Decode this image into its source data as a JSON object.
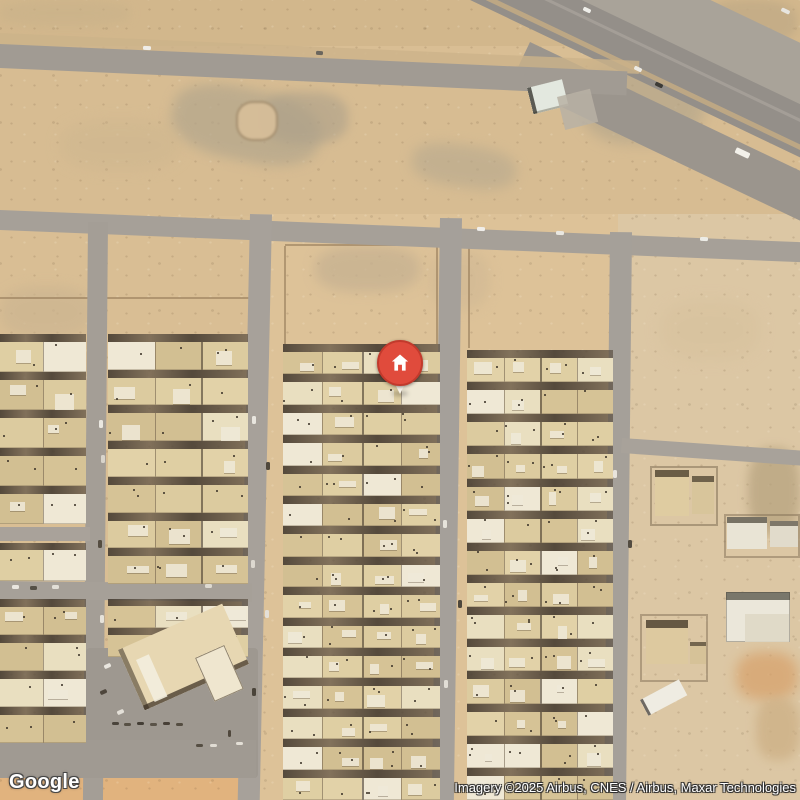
{
  "overlay": {
    "logo_text": "Google",
    "attribution_text": "Imagery ©2025 Airbus, CNES / Airbus, Maxar Technologies"
  },
  "marker": {
    "x": 400,
    "y": 363,
    "r": 23,
    "fill": "#e04b3c",
    "ring": "#c23a2c",
    "tail_color": "#f7f2e8",
    "glyph_color": "#ffffff"
  },
  "map": {
    "width": 800,
    "height": 800,
    "base_color": "#d9be94",
    "wall_color": "rgba(148,122,88,0.6)",
    "alley_color_a": "rgba(66,57,47,0.88)",
    "alley_color_b": "rgba(92,80,66,0.7)",
    "house_palette": [
      "#dccb9f",
      "#e2d2a8",
      "#d6c396",
      "#e9dfc0",
      "#dfcfa3",
      "#efe8d5",
      "#d2bf92"
    ]
  },
  "zones": [
    {
      "x": 0,
      "y": 0,
      "w": 800,
      "h": 46,
      "c": "#d2b78c"
    },
    {
      "x": 0,
      "y": 68,
      "w": 800,
      "h": 148,
      "c": "#d7bc92"
    },
    {
      "x": 252,
      "y": 214,
      "w": 366,
      "h": 586,
      "c": "#ddc298"
    },
    {
      "x": 618,
      "y": 214,
      "w": 182,
      "h": 586,
      "c": "#dcc7a4"
    },
    {
      "x": 0,
      "y": 774,
      "w": 252,
      "h": 26,
      "c": "#e1b37e"
    }
  ],
  "patches": [
    {
      "x": 180,
      "y": 74,
      "w": 150,
      "h": 72,
      "c": "#b3a68c",
      "bl": 6,
      "op": 0.7,
      "rot": 12
    },
    {
      "x": 262,
      "y": 92,
      "w": 86,
      "h": 52,
      "c": "#aca08a",
      "bl": 5,
      "op": 0.6
    },
    {
      "x": 236,
      "y": 101,
      "w": 42,
      "h": 40,
      "c": "#d8bf9a",
      "bl": 1,
      "op": 0.9,
      "sh": "inset 0 0 0 2px rgba(120,100,72,0.55)"
    },
    {
      "x": 580,
      "y": 56,
      "w": 125,
      "h": 88,
      "c": "#b2a58b",
      "bl": 7,
      "op": 0.65
    },
    {
      "x": 415,
      "y": 138,
      "w": 105,
      "h": 42,
      "c": "#b7a98e",
      "bl": 6,
      "op": 0.6,
      "rot": 8
    },
    {
      "x": 315,
      "y": 246,
      "w": 105,
      "h": 46,
      "c": "#c6b191",
      "bl": 6,
      "op": 0.75
    },
    {
      "x": 705,
      "y": 0,
      "w": 92,
      "h": 44,
      "c": "#c3ac87",
      "bl": 4,
      "op": 0.85
    },
    {
      "x": 0,
      "y": 286,
      "w": 92,
      "h": 52,
      "c": "#ccb591",
      "bl": 6,
      "op": 0.7
    },
    {
      "x": 748,
      "y": 448,
      "w": 52,
      "h": 86,
      "c": "#b5a17d",
      "bl": 5,
      "op": 0.7
    },
    {
      "x": 736,
      "y": 652,
      "w": 62,
      "h": 48,
      "c": "#d7a069",
      "bl": 6,
      "op": 0.7
    },
    {
      "x": 756,
      "y": 698,
      "w": 44,
      "h": 62,
      "c": "#ccae83",
      "bl": 5,
      "op": 0.7
    },
    {
      "x": 60,
      "y": 120,
      "w": 120,
      "h": 50,
      "c": "#cdb68f",
      "bl": 7,
      "op": 0.5
    },
    {
      "x": 430,
      "y": 250,
      "w": 60,
      "h": 60,
      "c": "#cdb693",
      "bl": 6,
      "op": 0.5
    },
    {
      "x": 0,
      "y": 0,
      "w": 130,
      "h": 26,
      "c": "#c9b28a",
      "bl": 5,
      "op": 0.6
    },
    {
      "x": 660,
      "y": 300,
      "w": 100,
      "h": 60,
      "c": "#d6c09c",
      "bl": 7,
      "op": 0.5
    }
  ],
  "walls": [
    {
      "x": 0,
      "y": 297,
      "w": 250,
      "h": 2
    },
    {
      "x": 285,
      "y": 244,
      "w": 152,
      "h": 2
    },
    {
      "x": 284,
      "y": 246,
      "w": 2,
      "h": 98
    },
    {
      "x": 436,
      "y": 246,
      "w": 2,
      "h": 98
    },
    {
      "x": 469,
      "y": 240,
      "w": 142,
      "h": 2
    },
    {
      "x": 468,
      "y": 242,
      "w": 2,
      "h": 106
    },
    {
      "x": 0,
      "y": 226,
      "w": 86,
      "h": 2,
      "op": 0.4
    },
    {
      "x": 110,
      "y": 226,
      "w": 138,
      "h": 2,
      "op": 0.4
    }
  ],
  "roads": [
    {
      "n": "highway-service-lane",
      "x": 375,
      "y": -160,
      "w": 780,
      "h": 56,
      "rot": 25.5,
      "c": "#a9a399"
    },
    {
      "n": "highway-main",
      "x": 351,
      "y": -110,
      "w": 780,
      "h": 48,
      "rot": 25.5,
      "c": "#948f89"
    },
    {
      "n": "highway-shoulder",
      "x": 530,
      "y": 42,
      "w": 370,
      "h": 45,
      "rot": 25.5,
      "c": "#9b958d"
    },
    {
      "n": "highway-median",
      "x": 340,
      "y": -75,
      "w": 780,
      "h": 5,
      "rot": 25.5,
      "c": "#c1aa84",
      "op": 0.9
    },
    {
      "n": "highway-lane-line",
      "x": 352,
      "y": -95,
      "w": 780,
      "h": 3,
      "rot": 25.5,
      "c": "#a5a099",
      "op": 0.9
    },
    {
      "n": "road-north-shoulder",
      "x": 0,
      "y": 33,
      "w": 640,
      "h": 13,
      "rot": 2.5,
      "c": "#ccb389",
      "op": 0.8
    },
    {
      "n": "road-north",
      "x": 0,
      "y": 44,
      "w": 628,
      "h": 24,
      "rot": 2.5,
      "c": "#a19b93"
    },
    {
      "n": "road-mid",
      "x": 0,
      "y": 210,
      "w": 812,
      "h": 20,
      "rot": 2.3,
      "c": "#a6a098"
    },
    {
      "n": "street-v1",
      "x": 88,
      "y": 222,
      "w": 20,
      "h": 580,
      "rot": 0.5,
      "c": "#a49e96"
    },
    {
      "n": "street-v2",
      "x": 250,
      "y": 214,
      "w": 22,
      "h": 590,
      "rot": 1.2,
      "c": "#a7a19a"
    },
    {
      "n": "street-v3",
      "x": 440,
      "y": 218,
      "w": 22,
      "h": 586,
      "rot": 0.8,
      "c": "#a5a09a"
    },
    {
      "n": "street-v4",
      "x": 610,
      "y": 232,
      "w": 22,
      "h": 572,
      "rot": 0.6,
      "c": "#a5a099"
    },
    {
      "n": "street-h-left",
      "x": 0,
      "y": 527,
      "w": 90,
      "h": 14,
      "c": "#a9a29a"
    },
    {
      "n": "street-h1",
      "x": 0,
      "y": 581,
      "w": 252,
      "h": 18,
      "rot": 0.6,
      "c": "#a6a098"
    },
    {
      "n": "street-branch-east",
      "x": 622,
      "y": 438,
      "w": 186,
      "h": 15,
      "rot": 4,
      "c": "#a8a29a"
    },
    {
      "n": "parking-southwest",
      "x": 86,
      "y": 648,
      "w": 172,
      "h": 130,
      "c": "#9e9890",
      "rad": 4
    },
    {
      "n": "parking-southwest-2",
      "x": 0,
      "y": 740,
      "w": 256,
      "h": 38,
      "c": "#a09a92"
    }
  ],
  "blocks": [
    {
      "n": "housing-block-a1",
      "x": 0,
      "y": 334,
      "w": 86,
      "h": 190,
      "rows": 5,
      "cols": 2,
      "alley": 8,
      "seed": 11
    },
    {
      "n": "housing-block-a1-mid",
      "x": 0,
      "y": 543,
      "w": 86,
      "h": 38,
      "rows": 1,
      "cols": 2,
      "alley": 7,
      "seed": 12
    },
    {
      "n": "housing-block-a1-south",
      "x": 0,
      "y": 599,
      "w": 86,
      "h": 144,
      "rows": 4,
      "cols": 2,
      "alley": 8,
      "seed": 13
    },
    {
      "n": "housing-block-a2",
      "x": 108,
      "y": 334,
      "w": 140,
      "h": 250,
      "rows": 7,
      "cols": 3,
      "alley": 8,
      "seed": 14
    },
    {
      "n": "housing-block-a2-south",
      "x": 108,
      "y": 599,
      "w": 140,
      "h": 58,
      "rows": 2,
      "cols": 3,
      "alley": 7,
      "seed": 15
    },
    {
      "n": "housing-block-center",
      "x": 283,
      "y": 344,
      "w": 157,
      "h": 456,
      "rows": 15,
      "cols": 4,
      "alley": 8,
      "seed": 16
    },
    {
      "n": "housing-block-east",
      "x": 467,
      "y": 350,
      "w": 146,
      "h": 450,
      "rows": 14,
      "cols": 4,
      "alley": 8,
      "seed": 17
    }
  ],
  "buildings": [
    {
      "n": "warehouse-north",
      "parts": [
        {
          "x": 527,
          "y": 88,
          "w": 36,
          "h": 27,
          "rot": -14,
          "c": "#e3e8df",
          "sh": "inset 4px 0 0 rgba(45,44,38,0.75), inset 0 -2px 0 rgba(120,115,100,0.5)"
        },
        {
          "x": 557,
          "y": 97,
          "w": 34,
          "h": 34,
          "rot": -14,
          "c": "#b8b2a5",
          "op": 0.85
        }
      ]
    },
    {
      "n": "event-hall",
      "parts": [
        {
          "x": 118,
          "y": 650,
          "w": 114,
          "h": 66,
          "rot": -24,
          "c": "#e7d7b2",
          "sh": "inset 0 -5px 0 rgba(52,42,30,0.7), inset 5px 0 0 rgba(60,50,36,0.55)"
        },
        {
          "x": 136,
          "y": 660,
          "w": 14,
          "h": 46,
          "rot": -24,
          "c": "#f3eede",
          "op": 0.9
        },
        {
          "x": 195,
          "y": 658,
          "w": 32,
          "h": 48,
          "rot": -24,
          "c": "#efe6cf",
          "sh": "inset 0 0 0 1px rgba(80,66,48,0.6)"
        }
      ]
    },
    {
      "n": "compound-northeast",
      "parts": [
        {
          "x": 650,
          "y": 466,
          "w": 68,
          "h": 60,
          "c": "rgba(0,0,0,0)",
          "sh": "inset 0 0 0 2px rgba(130,112,86,0.55)"
        },
        {
          "x": 655,
          "y": 470,
          "w": 34,
          "h": 46,
          "c": "#dfcca1",
          "sh": "inset 0 7px 0 rgba(55,45,32,0.7)"
        },
        {
          "x": 692,
          "y": 476,
          "w": 22,
          "h": 38,
          "c": "#d8c59b",
          "sh": "inset 0 6px 0 rgba(55,45,32,0.65)"
        }
      ]
    },
    {
      "n": "compound-east",
      "parts": [
        {
          "x": 724,
          "y": 514,
          "w": 76,
          "h": 44,
          "c": "rgba(0,0,0,0)",
          "sh": "inset 0 0 0 2px rgba(130,112,86,0.5)"
        },
        {
          "x": 727,
          "y": 517,
          "w": 40,
          "h": 32,
          "c": "#e9e4d5",
          "sh": "inset 0 6px 0 rgba(60,52,40,0.65)"
        },
        {
          "x": 770,
          "y": 521,
          "w": 28,
          "h": 26,
          "c": "#e1dbcb",
          "sh": "inset 0 5px 0 rgba(60,52,40,0.6)"
        }
      ]
    },
    {
      "n": "compound-southeast-white",
      "parts": [
        {
          "x": 726,
          "y": 592,
          "w": 64,
          "h": 50,
          "c": "#ebe7da",
          "sh": "inset 0 8px 0 rgba(60,58,48,0.65), inset 0 0 0 1px rgba(90,85,70,0.4)"
        },
        {
          "x": 745,
          "y": 614,
          "w": 44,
          "h": 28,
          "c": "#dfd8c5",
          "op": 0.9
        }
      ]
    },
    {
      "n": "compound-south",
      "parts": [
        {
          "x": 640,
          "y": 614,
          "w": 68,
          "h": 68,
          "c": "rgba(0,0,0,0)",
          "sh": "inset 0 0 0 2px rgba(130,112,86,0.5)"
        },
        {
          "x": 646,
          "y": 620,
          "w": 42,
          "h": 44,
          "c": "#ddc99f",
          "sh": "inset 0 8px 0 rgba(50,40,28,0.7)"
        },
        {
          "x": 690,
          "y": 642,
          "w": 16,
          "h": 22,
          "c": "#d6c298",
          "sh": "inset 0 4px 0 rgba(50,40,28,0.6)"
        }
      ]
    },
    {
      "n": "shed-south",
      "parts": [
        {
          "x": 640,
          "y": 700,
          "w": 44,
          "h": 18,
          "rot": -28,
          "c": "#efece2",
          "sh": "inset 3px 0 0 rgba(55,50,44,0.7)"
        }
      ]
    }
  ],
  "vehicles": [
    {
      "x": 735,
      "y": 150,
      "w": 15,
      "h": 6,
      "rot": 25,
      "c": "#f3f1ea"
    },
    {
      "x": 655,
      "y": 83,
      "w": 8,
      "h": 4,
      "rot": 25,
      "c": "#3d3b36"
    },
    {
      "x": 634,
      "y": 67,
      "w": 8,
      "h": 4,
      "rot": 25,
      "c": "#eceae4"
    },
    {
      "x": 583,
      "y": 8,
      "w": 8,
      "h": 4,
      "rot": 25,
      "c": "#efeee9"
    },
    {
      "x": 781,
      "y": 9,
      "w": 9,
      "h": 4,
      "rot": 25,
      "c": "#e7e5df"
    },
    {
      "x": 143,
      "y": 46,
      "w": 8,
      "h": 4,
      "rot": 2,
      "c": "#efede8"
    },
    {
      "x": 316,
      "y": 51,
      "w": 7,
      "h": 4,
      "rot": 2,
      "c": "#6b665d"
    },
    {
      "x": 477,
      "y": 227,
      "w": 8,
      "h": 4,
      "rot": 2,
      "c": "#f0eeea"
    },
    {
      "x": 556,
      "y": 231,
      "w": 8,
      "h": 4,
      "rot": 2,
      "c": "#e9e7e1"
    },
    {
      "x": 700,
      "y": 237,
      "w": 8,
      "h": 4,
      "rot": 2,
      "c": "#ecece6"
    },
    {
      "x": 252,
      "y": 416,
      "w": 4,
      "h": 8,
      "rot": 0,
      "c": "#e8e5de"
    },
    {
      "x": 266,
      "y": 462,
      "w": 4,
      "h": 8,
      "rot": 0,
      "c": "#50483c"
    },
    {
      "x": 251,
      "y": 560,
      "w": 4,
      "h": 8,
      "rot": 0,
      "c": "#ddd8cf"
    },
    {
      "x": 265,
      "y": 610,
      "w": 4,
      "h": 8,
      "rot": 0,
      "c": "#e4e0d8"
    },
    {
      "x": 252,
      "y": 688,
      "w": 4,
      "h": 8,
      "rot": 0,
      "c": "#4a443a"
    },
    {
      "x": 99,
      "y": 420,
      "w": 4,
      "h": 8,
      "rot": 0,
      "c": "#eae7e0"
    },
    {
      "x": 101,
      "y": 455,
      "w": 4,
      "h": 8,
      "rot": 0,
      "c": "#d8d4cb"
    },
    {
      "x": 98,
      "y": 540,
      "w": 4,
      "h": 8,
      "rot": 0,
      "c": "#554d41"
    },
    {
      "x": 100,
      "y": 615,
      "w": 4,
      "h": 8,
      "rot": 0,
      "c": "#e6e2da"
    },
    {
      "x": 12,
      "y": 585,
      "w": 7,
      "h": 4,
      "rot": 0,
      "c": "#e9e6df"
    },
    {
      "x": 30,
      "y": 586,
      "w": 7,
      "h": 4,
      "rot": 0,
      "c": "#555046"
    },
    {
      "x": 52,
      "y": 585,
      "w": 7,
      "h": 4,
      "rot": 0,
      "c": "#e2dfd7"
    },
    {
      "x": 205,
      "y": 584,
      "w": 7,
      "h": 4,
      "rot": 0,
      "c": "#ddd9d0"
    },
    {
      "x": 443,
      "y": 520,
      "w": 4,
      "h": 8,
      "rot": 0,
      "c": "#e6e3db"
    },
    {
      "x": 458,
      "y": 600,
      "w": 4,
      "h": 8,
      "rot": 0,
      "c": "#4e473c"
    },
    {
      "x": 444,
      "y": 680,
      "w": 4,
      "h": 8,
      "rot": 0,
      "c": "#e2ded6"
    },
    {
      "x": 613,
      "y": 470,
      "w": 4,
      "h": 8,
      "rot": 0,
      "c": "#e8e4dc"
    },
    {
      "x": 628,
      "y": 540,
      "w": 4,
      "h": 8,
      "rot": 0,
      "c": "#534c41"
    },
    {
      "x": 112,
      "y": 722,
      "w": 7,
      "h": 3,
      "rot": 0,
      "c": "#4a443b"
    },
    {
      "x": 124,
      "y": 723,
      "w": 7,
      "h": 3,
      "rot": 0,
      "c": "#575044"
    },
    {
      "x": 137,
      "y": 722,
      "w": 7,
      "h": 3,
      "rot": 0,
      "c": "#443e35"
    },
    {
      "x": 150,
      "y": 723,
      "w": 7,
      "h": 3,
      "rot": 0,
      "c": "#5a5348"
    },
    {
      "x": 163,
      "y": 722,
      "w": 7,
      "h": 3,
      "rot": 0,
      "c": "#473f36"
    },
    {
      "x": 176,
      "y": 723,
      "w": 7,
      "h": 3,
      "rot": 0,
      "c": "#544d41"
    },
    {
      "x": 228,
      "y": 730,
      "w": 3,
      "h": 7,
      "rot": 0,
      "c": "#50483d"
    },
    {
      "x": 236,
      "y": 742,
      "w": 7,
      "h": 3,
      "rot": 0,
      "c": "#e3dfd6"
    },
    {
      "x": 196,
      "y": 744,
      "w": 7,
      "h": 3,
      "rot": 0,
      "c": "#554e43"
    },
    {
      "x": 210,
      "y": 744,
      "w": 7,
      "h": 3,
      "rot": 0,
      "c": "#e0dcd3"
    },
    {
      "x": 104,
      "y": 664,
      "w": 7,
      "h": 4,
      "rot": -25,
      "c": "#e9e6df"
    },
    {
      "x": 100,
      "y": 690,
      "w": 7,
      "h": 4,
      "rot": -25,
      "c": "#4e463c"
    },
    {
      "x": 117,
      "y": 710,
      "w": 7,
      "h": 4,
      "rot": -25,
      "c": "#e4e0d8"
    }
  ]
}
